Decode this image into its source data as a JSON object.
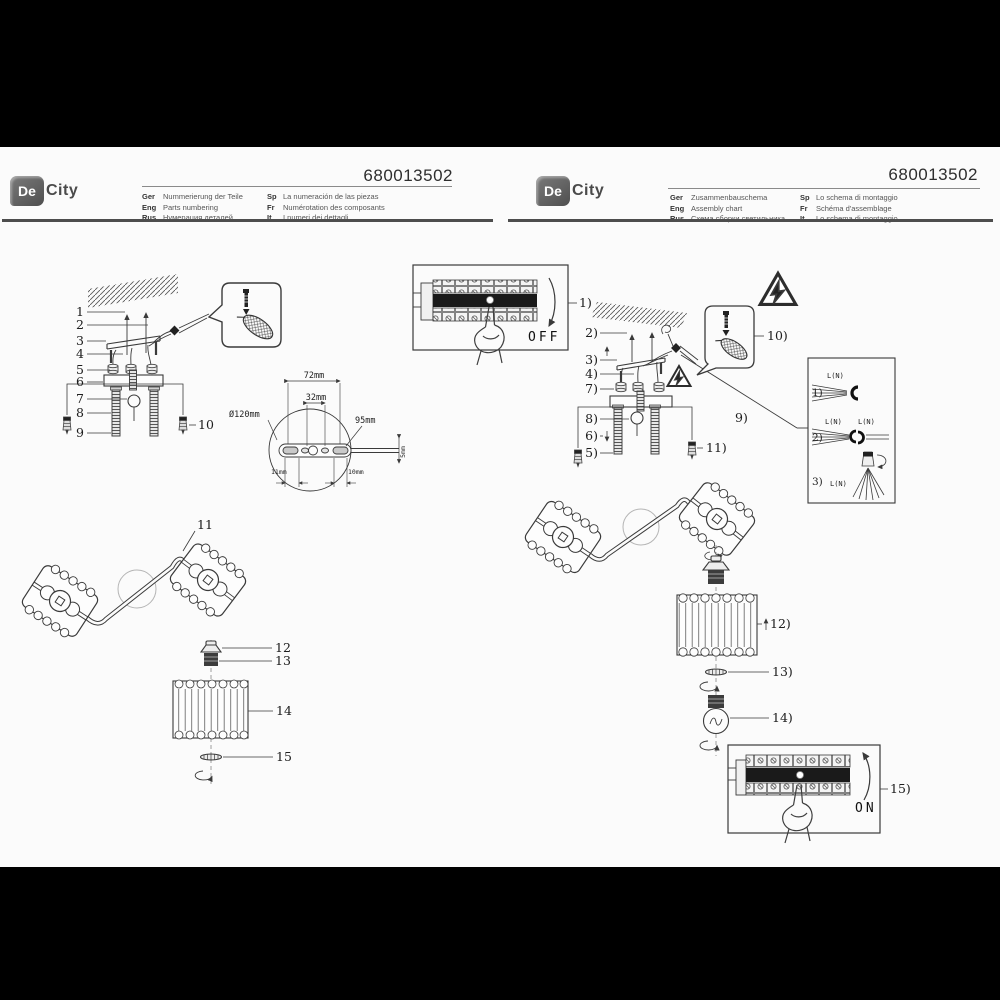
{
  "brand": {
    "de": "De",
    "city": "City"
  },
  "left_page": {
    "header": {
      "model": "680013502",
      "rows": [
        {
          "code": "Ger",
          "text": "Nummerierung der Teile"
        },
        {
          "code": "Eng",
          "text": "Parts numbering"
        },
        {
          "code": "Rus",
          "text": "Нумерация деталей"
        },
        {
          "code": "Sp",
          "text": "La numeración de las piezas"
        },
        {
          "code": "Fr",
          "text": "Numérotation des composants"
        },
        {
          "code": "It",
          "text": "I numeri dei dettagli"
        }
      ]
    },
    "parts": [
      "1",
      "2",
      "3",
      "4",
      "5",
      "6",
      "7",
      "8",
      "9",
      "10",
      "11",
      "12",
      "13",
      "14",
      "15"
    ],
    "dims": {
      "d72": "72mm",
      "d32": "32mm",
      "dia": "Ø120mm",
      "d95": "95mm",
      "d11": "11mm",
      "d10": "10mm",
      "d5": "5mm"
    }
  },
  "right_page": {
    "header": {
      "model": "680013502",
      "rows": [
        {
          "code": "Ger",
          "text": "Zusammenbauschema"
        },
        {
          "code": "Eng",
          "text": "Assembly chart"
        },
        {
          "code": "Rus",
          "text": "Схема сборки светильника"
        },
        {
          "code": "Sp",
          "text": "Lo schema di montaggio"
        },
        {
          "code": "Fr",
          "text": "Schéma d'assemblage"
        },
        {
          "code": "It",
          "text": "Lo schema di montaggio"
        }
      ]
    },
    "steps": [
      "1)",
      "2)",
      "3)",
      "4)",
      "5)",
      "6)",
      "7)",
      "8)",
      "9)",
      "10)",
      "11)",
      "12)",
      "13)",
      "14)",
      "15)"
    ],
    "switch": {
      "off": "OFF",
      "on": "ON"
    },
    "wiring": {
      "s1": "1)",
      "s2": "2)",
      "s3": "3)",
      "label": "L(N)"
    }
  }
}
